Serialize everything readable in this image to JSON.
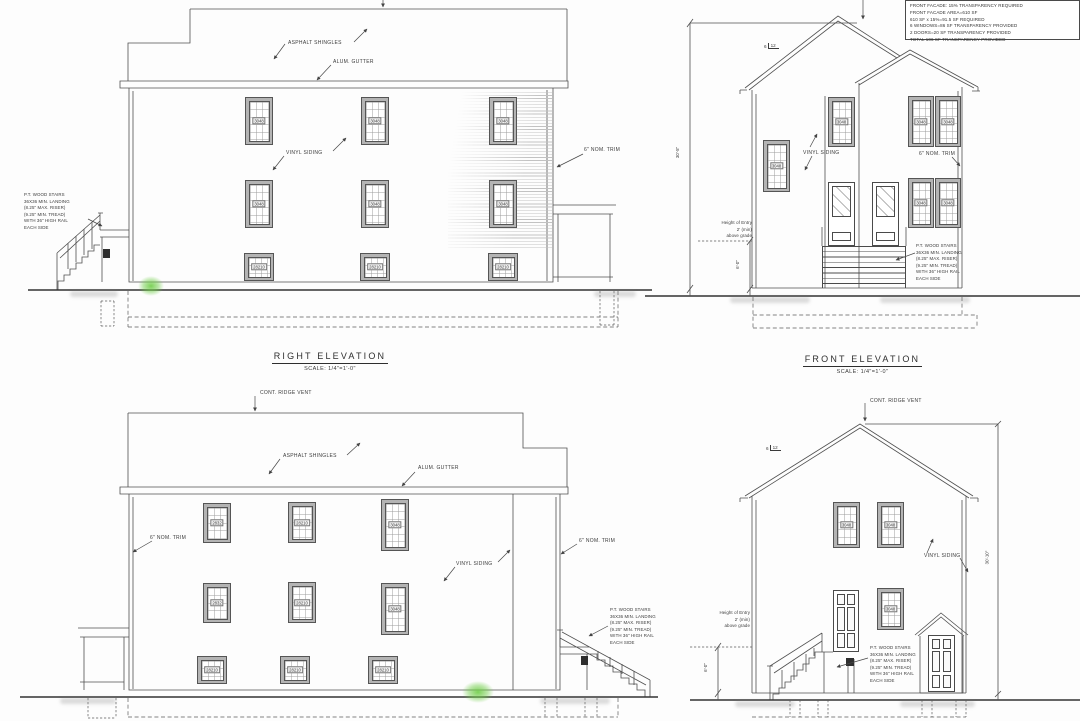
{
  "common": {
    "asphalt_shingles": "ASPHALT SHINGLES",
    "alum_gutter": "ALUM. GUTTER",
    "vinyl_siding": "VINYL SIDING",
    "nom_trim": "6\" NOM. TRIM",
    "ridge_vent": "CONT. RIDGE VENT",
    "stairs_note": "P.T. WOOD STAIRS\n36X36 MIN. LANDING\n(8.25\" MAX. RISER)\n(9.25\" MIN. TREAD)\nWITH 36\" HIGH RAIL\nEACH SIDE",
    "entry_note": "Height of Entry\n2' (min)\nabove grade",
    "entry_dim": "6'-0\"",
    "pitch_rise": "6",
    "pitch_run": "12"
  },
  "elevations": {
    "right": {
      "title": "RIGHT ELEVATION",
      "scale": "SCALE: 1/4\"=1'-0\"",
      "windows": [
        {
          "code": "3048",
          "x": 245,
          "y": 97,
          "w": 28,
          "h": 48
        },
        {
          "code": "3048",
          "x": 361,
          "y": 97,
          "w": 28,
          "h": 48
        },
        {
          "code": "3048",
          "x": 489,
          "y": 97,
          "w": 28,
          "h": 48
        },
        {
          "code": "3048",
          "x": 245,
          "y": 180,
          "w": 28,
          "h": 48
        },
        {
          "code": "3048",
          "x": 361,
          "y": 180,
          "w": 28,
          "h": 48
        },
        {
          "code": "3048",
          "x": 489,
          "y": 180,
          "w": 28,
          "h": 48
        },
        {
          "code": "28210",
          "x": 244,
          "y": 253,
          "w": 30,
          "h": 28
        },
        {
          "code": "28210",
          "x": 360,
          "y": 253,
          "w": 30,
          "h": 28
        },
        {
          "code": "28210",
          "x": 488,
          "y": 253,
          "w": 30,
          "h": 28
        }
      ]
    },
    "front": {
      "title": "FRONT ELEVATION",
      "scale": "SCALE: 1/4\"=1'-0\"",
      "height_dim": "30'-5\"",
      "transparency_note": "FRONT FACADE: 15% TRANSPARENCY REQUIRED\nFRONT FACADE AREA=610 SF\n610 SF x 15%=91.5 SF REQUIRED\n6 WINDOWS=86 SF TRANSPARENCY PROVIDED\n2 DOORS=20 SF TRANSPARENCY PROVIDED\nTOTAL 106 SF TRANSPARENCY PROVIDED",
      "windows": [
        {
          "code": "3048",
          "x": 123,
          "y": 140,
          "w": 27,
          "h": 52
        },
        {
          "code": "3048",
          "x": 188,
          "y": 97,
          "w": 27,
          "h": 50
        },
        {
          "code": "3048",
          "x": 268,
          "y": 96,
          "w": 26,
          "h": 51
        },
        {
          "code": "3048",
          "x": 295,
          "y": 96,
          "w": 26,
          "h": 51
        },
        {
          "code": "3048",
          "x": 268,
          "y": 178,
          "w": 26,
          "h": 50
        },
        {
          "code": "3048",
          "x": 295,
          "y": 178,
          "w": 26,
          "h": 50
        }
      ]
    },
    "left": {
      "windows": [
        {
          "code": "2832",
          "x": 203,
          "y": 118,
          "w": 28,
          "h": 40
        },
        {
          "code": "28210",
          "x": 288,
          "y": 117,
          "w": 28,
          "h": 41
        },
        {
          "code": "3048",
          "x": 381,
          "y": 114,
          "w": 28,
          "h": 52
        },
        {
          "code": "2832",
          "x": 203,
          "y": 198,
          "w": 28,
          "h": 40
        },
        {
          "code": "28210",
          "x": 288,
          "y": 197,
          "w": 28,
          "h": 41
        },
        {
          "code": "3048",
          "x": 381,
          "y": 198,
          "w": 28,
          "h": 52
        },
        {
          "code": "28210",
          "x": 197,
          "y": 271,
          "w": 30,
          "h": 28
        },
        {
          "code": "28210",
          "x": 280,
          "y": 271,
          "w": 30,
          "h": 28
        },
        {
          "code": "28210",
          "x": 368,
          "y": 271,
          "w": 30,
          "h": 28
        }
      ]
    },
    "rear": {
      "height_dim": "30'-10\"",
      "windows": [
        {
          "code": "3048",
          "x": 193,
          "y": 117,
          "w": 27,
          "h": 46
        },
        {
          "code": "3048",
          "x": 237,
          "y": 117,
          "w": 27,
          "h": 46
        },
        {
          "code": "3048",
          "x": 237,
          "y": 203,
          "w": 27,
          "h": 42
        }
      ]
    }
  }
}
